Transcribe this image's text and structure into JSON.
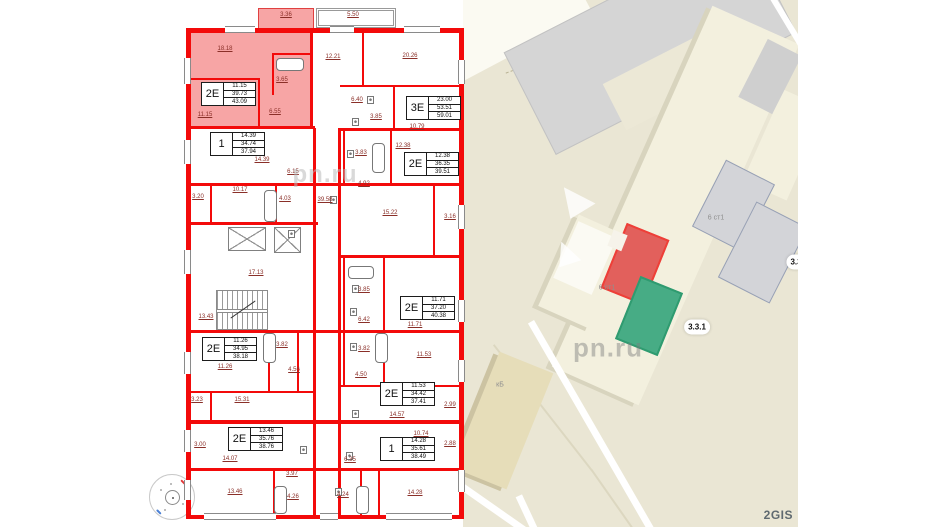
{
  "colors": {
    "wall_red": "#f30a0a",
    "apartment_highlight": "#f7a5a5",
    "map_background": "#eae6d4",
    "map_selected_section": "#e2605c",
    "map_selected_border": "#ee3f38",
    "map_secondary_section": "#47ac85",
    "map_secondary_border": "#2f9b70"
  },
  "plan": {
    "watermark": "pn.ru",
    "room_labels": [
      {
        "t": "3.36",
        "x": 286,
        "y": 15
      },
      {
        "t": "5.50",
        "x": 353,
        "y": 15
      },
      {
        "t": "18.18",
        "x": 225,
        "y": 49
      },
      {
        "t": "12.21",
        "x": 333,
        "y": 57
      },
      {
        "t": "20.26",
        "x": 410,
        "y": 56
      },
      {
        "t": "11.15",
        "x": 205,
        "y": 115
      },
      {
        "t": "3.65",
        "x": 282,
        "y": 80
      },
      {
        "t": "6.55",
        "x": 275,
        "y": 112
      },
      {
        "t": "6.40",
        "x": 357,
        "y": 100
      },
      {
        "t": "3.85",
        "x": 376,
        "y": 117
      },
      {
        "t": "10.79",
        "x": 417,
        "y": 127
      },
      {
        "t": "12.38",
        "x": 403,
        "y": 146
      },
      {
        "t": "3.83",
        "x": 361,
        "y": 153
      },
      {
        "t": "14.39",
        "x": 262,
        "y": 160
      },
      {
        "t": "6.15",
        "x": 293,
        "y": 172
      },
      {
        "t": "4.92",
        "x": 364,
        "y": 184
      },
      {
        "t": "3.20",
        "x": 198,
        "y": 197
      },
      {
        "t": "10.17",
        "x": 240,
        "y": 190
      },
      {
        "t": "4.03",
        "x": 285,
        "y": 199
      },
      {
        "t": "39.58",
        "x": 325,
        "y": 200
      },
      {
        "t": "15.22",
        "x": 390,
        "y": 213
      },
      {
        "t": "3.16",
        "x": 450,
        "y": 217
      },
      {
        "t": "17.13",
        "x": 256,
        "y": 273
      },
      {
        "t": "13.43",
        "x": 206,
        "y": 317
      },
      {
        "t": "3.85",
        "x": 364,
        "y": 290
      },
      {
        "t": "6.42",
        "x": 364,
        "y": 320
      },
      {
        "t": "11.71",
        "x": 415,
        "y": 325
      },
      {
        "t": "11.26",
        "x": 225,
        "y": 367
      },
      {
        "t": "3.82",
        "x": 282,
        "y": 345
      },
      {
        "t": "4.56",
        "x": 294,
        "y": 370
      },
      {
        "t": "3.82",
        "x": 364,
        "y": 349
      },
      {
        "t": "11.53",
        "x": 424,
        "y": 355
      },
      {
        "t": "4.50",
        "x": 361,
        "y": 375
      },
      {
        "t": "2.99",
        "x": 450,
        "y": 405
      },
      {
        "t": "14.57",
        "x": 397,
        "y": 415
      },
      {
        "t": "10.74",
        "x": 421,
        "y": 434
      },
      {
        "t": "2.88",
        "x": 450,
        "y": 444
      },
      {
        "t": "3.23",
        "x": 197,
        "y": 400
      },
      {
        "t": "15.31",
        "x": 242,
        "y": 400
      },
      {
        "t": "3.00",
        "x": 200,
        "y": 445
      },
      {
        "t": "14.07",
        "x": 230,
        "y": 459
      },
      {
        "t": "13.46",
        "x": 235,
        "y": 492
      },
      {
        "t": "3.97",
        "x": 292,
        "y": 474
      },
      {
        "t": "4.26",
        "x": 293,
        "y": 497
      },
      {
        "t": "4.24",
        "x": 343,
        "y": 495
      },
      {
        "t": "6.35",
        "x": 350,
        "y": 460
      },
      {
        "t": "14.28",
        "x": 415,
        "y": 493
      }
    ],
    "info_boxes": [
      {
        "type": "2Е",
        "rows": [
          "11.15",
          "39.73",
          "43.09"
        ],
        "x": 201,
        "y": 82,
        "selected": true
      },
      {
        "type": "3Е",
        "rows": [
          "23.00",
          "53.51",
          "59.01"
        ],
        "x": 406,
        "y": 96,
        "selected": false
      },
      {
        "type": "1",
        "rows": [
          "14.39",
          "34.74",
          "37.94"
        ],
        "x": 210,
        "y": 132,
        "selected": false
      },
      {
        "type": "2Е",
        "rows": [
          "12.38",
          "36.35",
          "39.51"
        ],
        "x": 404,
        "y": 152,
        "selected": false
      },
      {
        "type": "2Е",
        "rows": [
          "11.71",
          "37.20",
          "40.38"
        ],
        "x": 400,
        "y": 296,
        "selected": false
      },
      {
        "type": "2Е",
        "rows": [
          "11.26",
          "34.95",
          "38.18"
        ],
        "x": 202,
        "y": 337,
        "selected": false
      },
      {
        "type": "2Е",
        "rows": [
          "11.53",
          "34.42",
          "37.41"
        ],
        "x": 380,
        "y": 382,
        "selected": false
      },
      {
        "type": "1",
        "rows": [
          "14.28",
          "35.61",
          "38.49"
        ],
        "x": 380,
        "y": 437,
        "selected": false
      },
      {
        "type": "2Е",
        "rows": [
          "13.46",
          "35.76",
          "38.76"
        ],
        "x": 228,
        "y": 427,
        "selected": false
      }
    ]
  },
  "map": {
    "watermark": "pn.ru",
    "provider_logo": "2GIS",
    "building_labels": [
      {
        "t": "6 ст1",
        "x": 716,
        "y": 218
      },
      {
        "t": "6 ст1",
        "x": 607,
        "y": 288
      },
      {
        "t": "кБ",
        "x": 500,
        "y": 385
      }
    ],
    "pins": [
      {
        "t": "3.3.1",
        "x": 697,
        "y": 327
      },
      {
        "t": "3.3",
        "x": 796,
        "y": 262
      }
    ]
  }
}
